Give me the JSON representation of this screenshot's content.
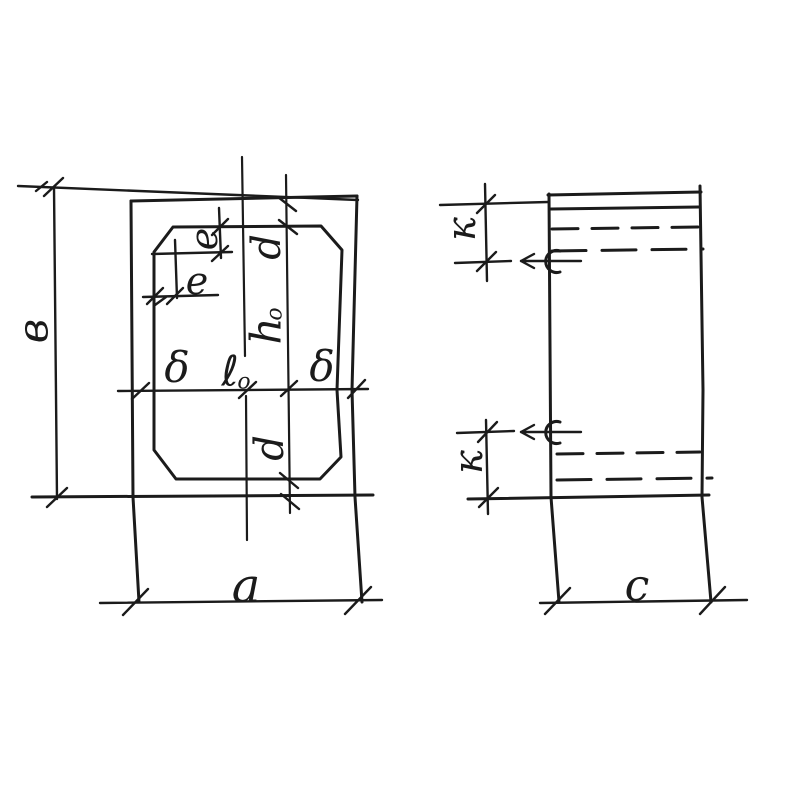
{
  "drawing": {
    "kind": "hand-drawn technical sketch, two orthographic views of a hollow block",
    "ink_color": "#1b1b1b",
    "background_color": "#ffffff"
  },
  "fig_plan": {
    "title": "plan-view-with-chamfered-opening",
    "dims": {
      "b": "в",
      "a": "a",
      "e_vertical": "e",
      "e_horizontal": "e",
      "d_top": "d",
      "d_bottom": "d",
      "h_main": "h",
      "h_sub": "o",
      "l_main": "ℓ",
      "l_sub": "o",
      "delta_left": "δ",
      "delta_right": "δ"
    }
  },
  "fig_side": {
    "title": "side-view-with-lifting-hooks",
    "dims": {
      "k_top": "к",
      "k_bottom": "к",
      "c": "c"
    }
  }
}
